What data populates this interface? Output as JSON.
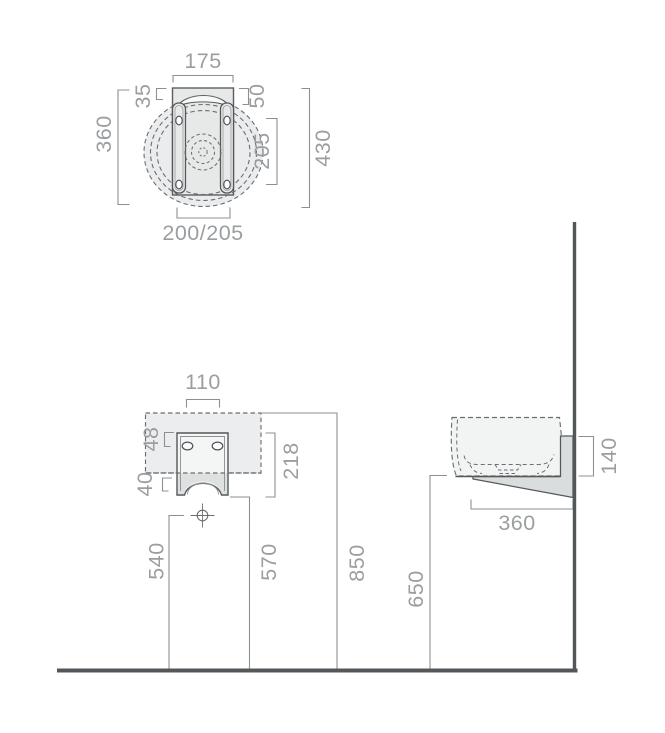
{
  "colors": {
    "dim_line": "#8d9093",
    "dim_text": "#9b9ea1",
    "outline": "#55585b",
    "dashed_line": "#6b6e71",
    "wall_floor": "#54575a",
    "fill_bowl": "#ebeced",
    "fill_panel": "#e7e9e9",
    "fill_basin_front": "#ecedee",
    "fill_bracket": "#f4f5f5",
    "fill_bracket_band": "#dde1e0",
    "fill_wedge": "#d9dddd"
  },
  "top_view": {
    "width": "175",
    "rim_offset": "35",
    "slot_offset": "50",
    "depth": "360",
    "hole_spacing": "205",
    "total_depth": "430",
    "base_width": "200/205"
  },
  "front_view": {
    "fixing_width": "110",
    "hole_offset": "48",
    "bracket_height": "218",
    "arch_height": "40",
    "drain_height": "540",
    "bracket_bottom_height": "570",
    "rim_height": "850"
  },
  "side_view": {
    "rear_height": "140",
    "depth": "360",
    "clearance_height": "650"
  }
}
